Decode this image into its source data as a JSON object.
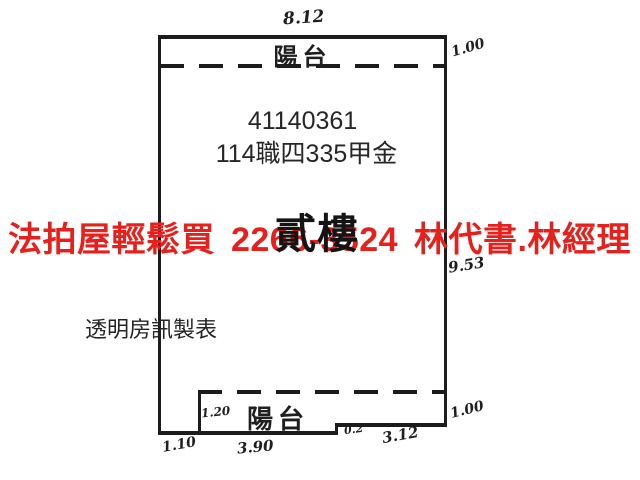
{
  "watermark": {
    "text": "法拍屋輕鬆買 2266-3524 林代書.林經理",
    "color": "#e8201c"
  },
  "plan": {
    "case_number": "41140361",
    "case_name": "114職四335甲金",
    "floor_label": "貳樓",
    "top_balcony_label": "陽台",
    "bottom_balcony_label": "陽台",
    "maker_credit": "透明房訊製表",
    "line_color": "#1c1c1c"
  },
  "dimensions": {
    "top_width": "8.12",
    "top_balcony_depth": "1.00",
    "right_height": "9.53",
    "bottom_balcony_depth": "1.20",
    "bottom_left": "1.10",
    "bottom_mid": "3.90",
    "bottom_step": "0.2",
    "bottom_right": "3.12",
    "bottom_right_depth": "1.00"
  }
}
